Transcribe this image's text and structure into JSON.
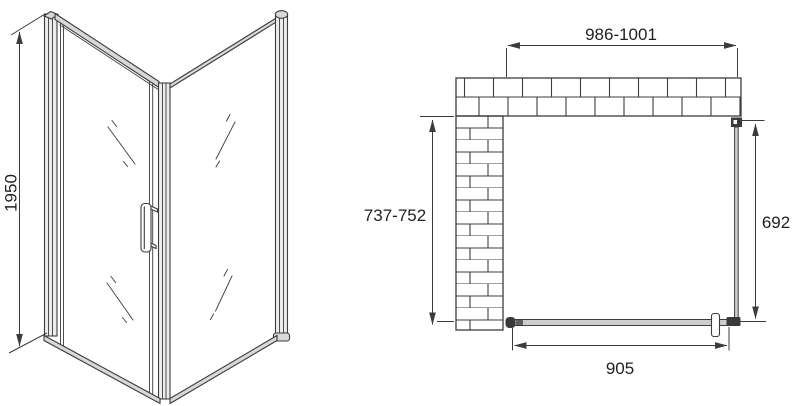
{
  "colors": {
    "line": "#3c3c3c",
    "text": "#222222",
    "metal_light": "#d8d8d8",
    "post_fill": "#ececec",
    "glass_fill": "#cdcdcd",
    "dark": "#3a3a3a",
    "background": "#ffffff"
  },
  "front_view": {
    "height_dimension": "1950"
  },
  "plan_view": {
    "width_dimension": "986-1001",
    "depth_dimension": "737-752",
    "side_panel_dimension": "692",
    "door_width_dimension": "905"
  }
}
